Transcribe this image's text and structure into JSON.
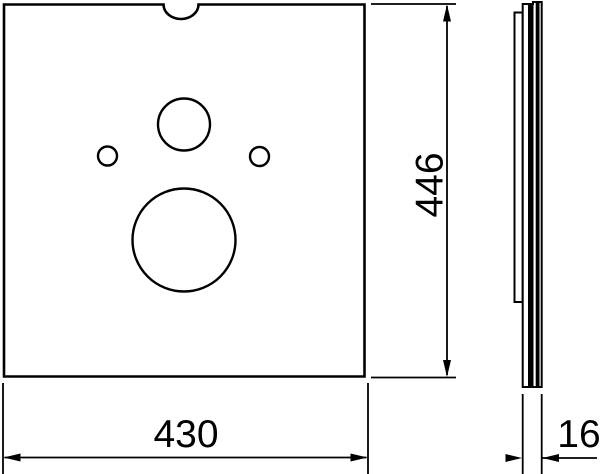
{
  "drawing": {
    "dimensions": {
      "width": "430",
      "height": "446",
      "thickness": "16"
    },
    "colors": {
      "line": "#000000",
      "background": "#ffffff"
    }
  }
}
